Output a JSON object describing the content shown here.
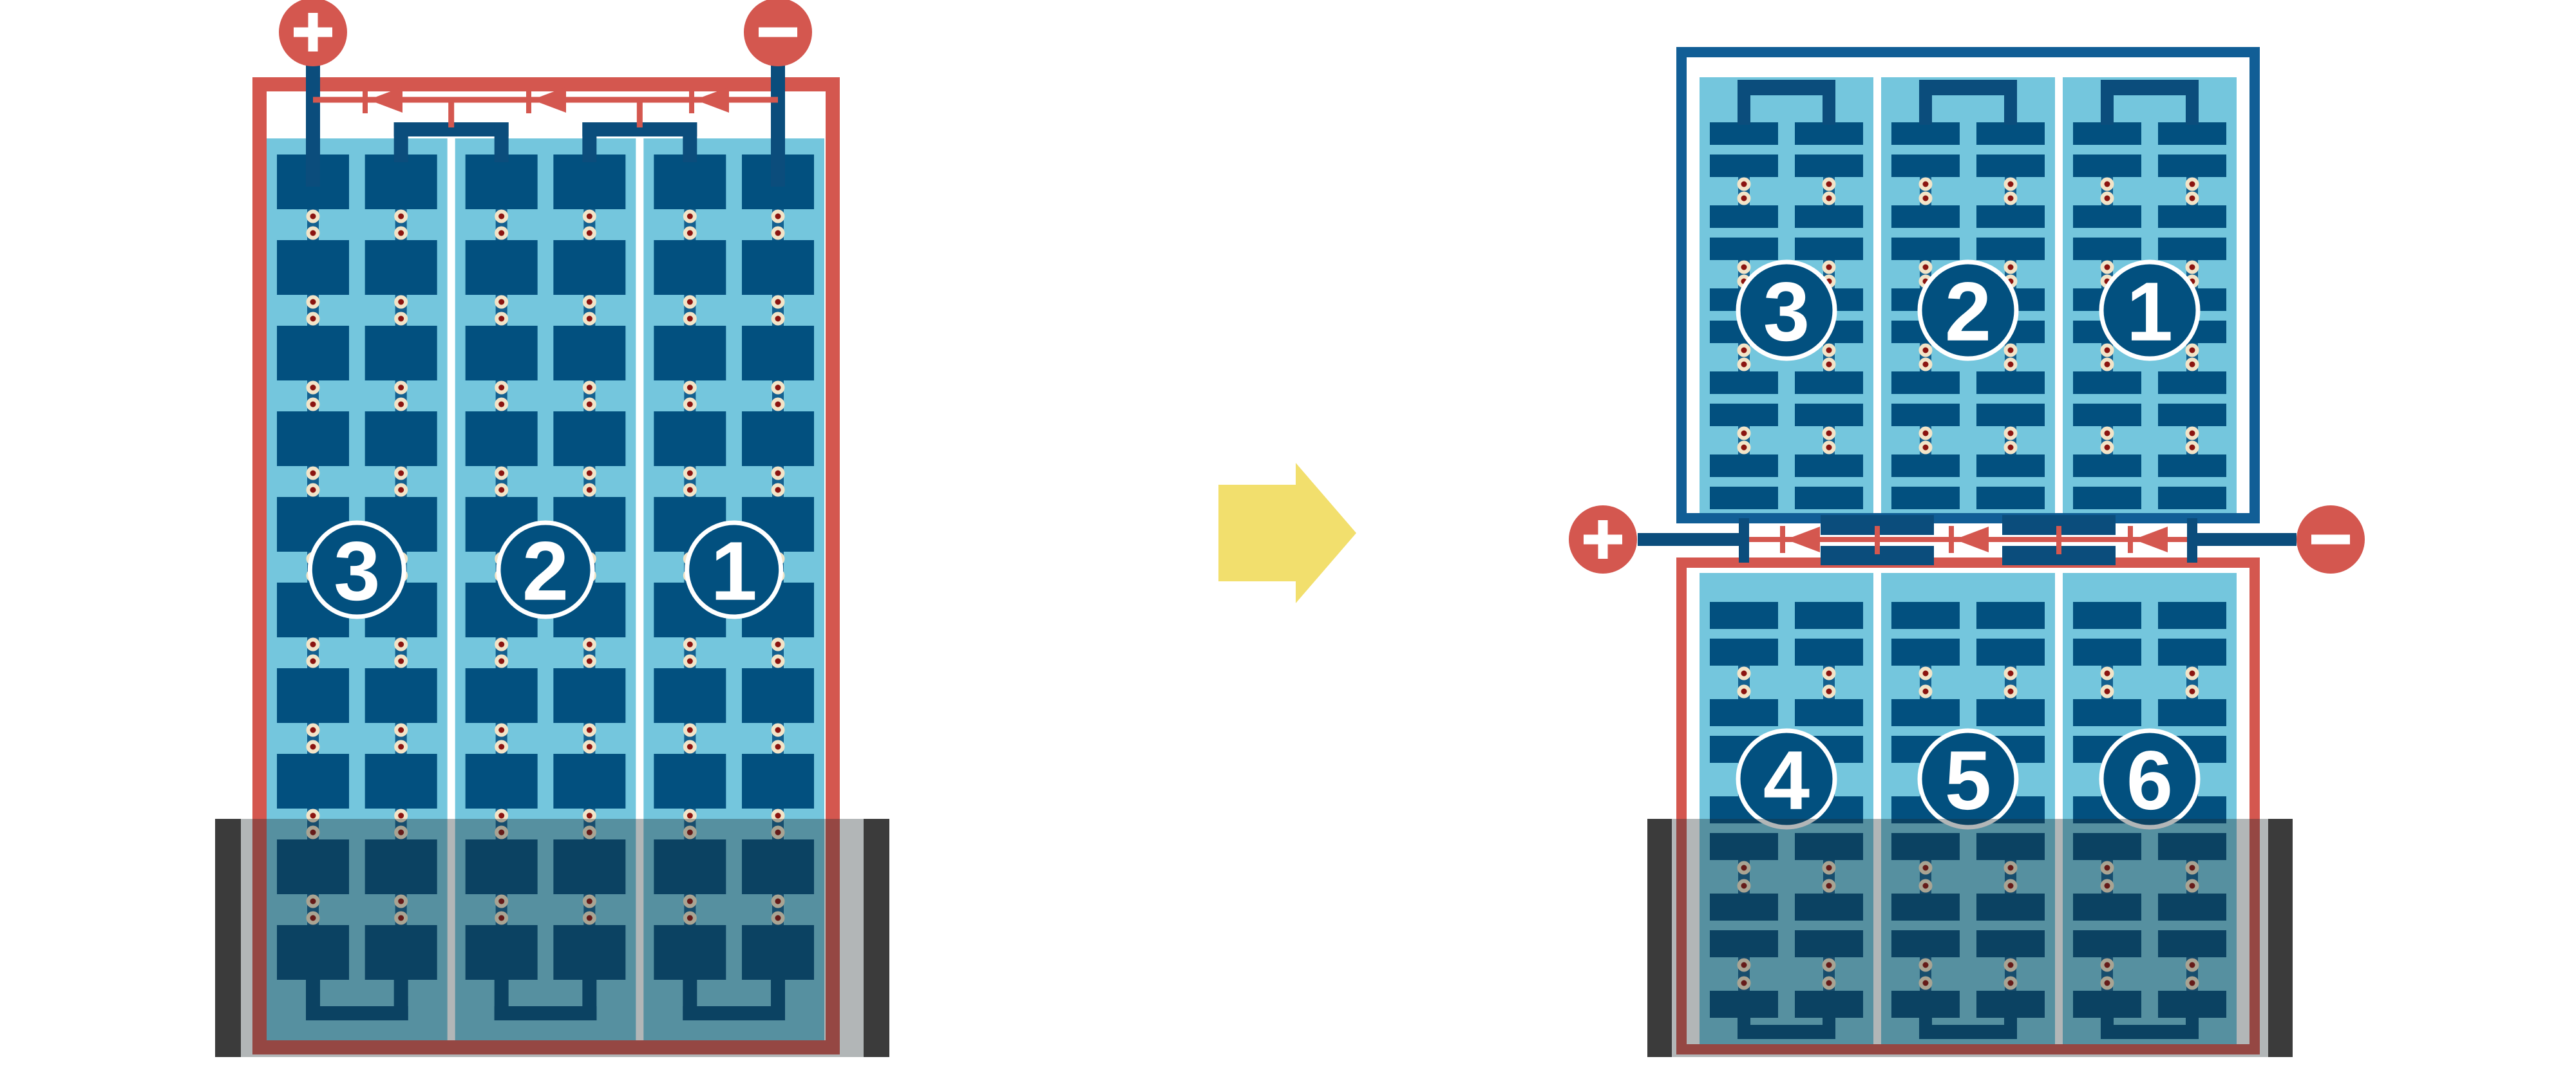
{
  "diagram_title": "",
  "colors": {
    "background": "#ffffff",
    "panel_light_blue": "#74C6DD",
    "cell_blue": "#02507F",
    "connector_blue": "#14608F",
    "frame_red": "#D4574F",
    "frame_blue": "#115E96",
    "wire_blue": "#0B4D7C",
    "dot_outer_cream": "#F2E4C8",
    "dot_inner_red": "#8B1410",
    "terminal_red": "#D4574F",
    "terminal_symbol_white": "#FFFFFF",
    "label_circle_fill": "#02507F",
    "label_circle_ring": "#FFFFFF",
    "label_text": "#FFFFFF",
    "arrow_yellow": "#F2DF6D",
    "shade_overlay": "rgba(30,40,45,0.34)",
    "shade_bar_gray": "#3B3B3B"
  },
  "icons": {
    "positive": "plus-icon",
    "negative": "minus-icon",
    "transition": "arrow-right-icon",
    "diode": "bypass-diode-icon"
  },
  "left_module": {
    "string_labels": [
      "3",
      "2",
      "1"
    ],
    "positive_label": "+",
    "negative_label": "−",
    "bypass_diodes": 3,
    "cell_rows": 10,
    "strings": 3
  },
  "right_module": {
    "top_string_labels": [
      "3",
      "2",
      "1"
    ],
    "bottom_string_labels": [
      "4",
      "5",
      "6"
    ],
    "positive_label": "+",
    "negative_label": "−",
    "bypass_diodes": 3,
    "top_cell_rows": 10,
    "bottom_cell_rows": 9,
    "strings_per_half": 3
  },
  "arrow": {
    "direction": "right"
  }
}
